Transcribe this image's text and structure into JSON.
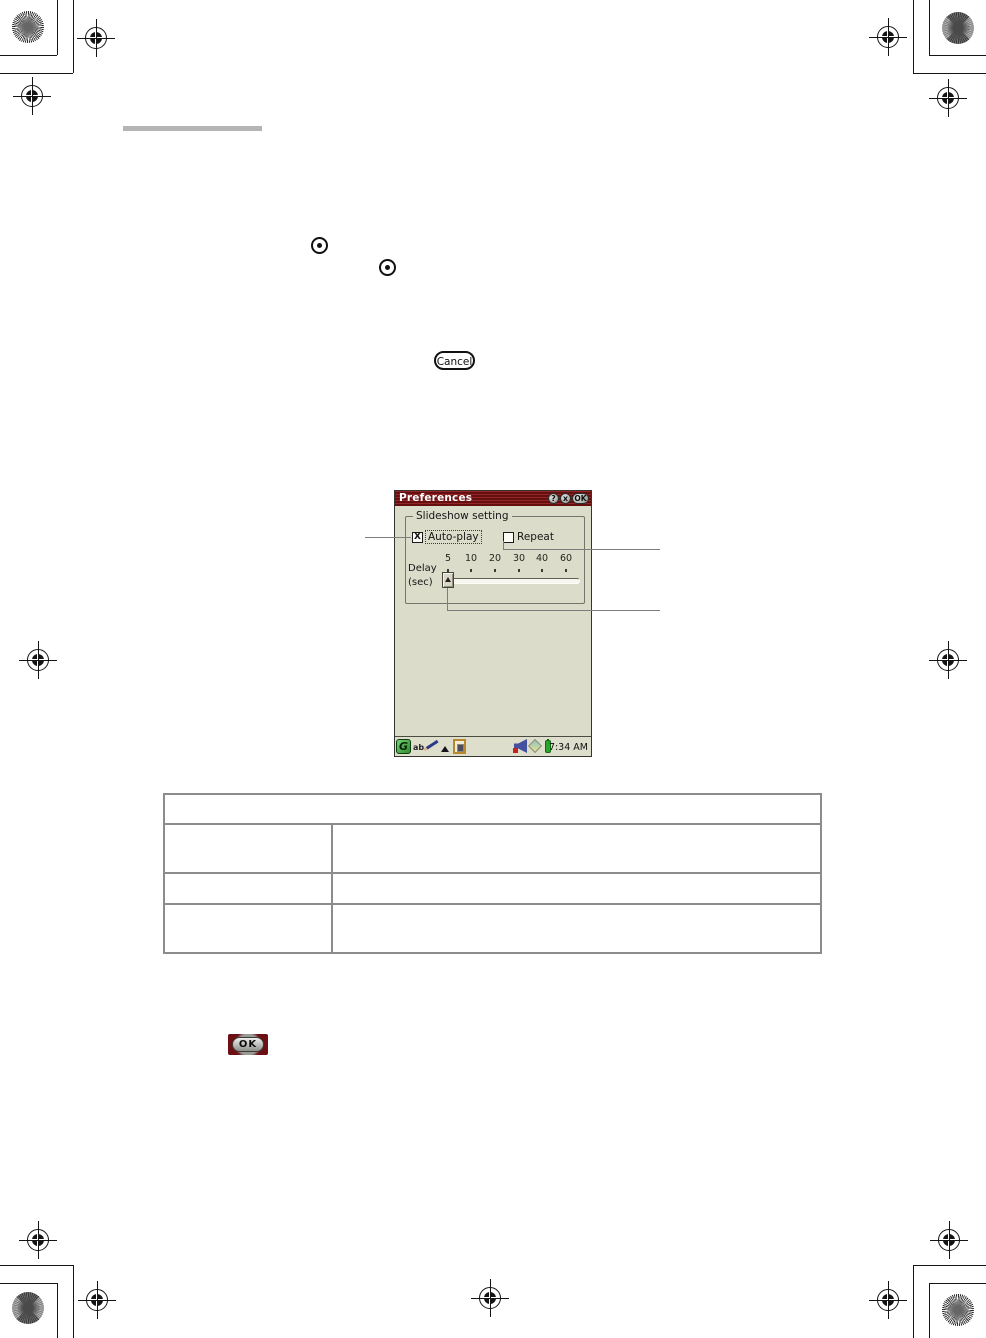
{
  "document": {
    "cancel_button_label": "Cancel",
    "ok_image_label": "OK"
  },
  "dialog": {
    "title": "Preferences",
    "titlebar_buttons": {
      "help": "?",
      "close": "x",
      "ok": "OK"
    },
    "group_label": "Slideshow setting",
    "autoplay_label": "Auto-play",
    "autoplay_checked": true,
    "autoplay_check_glyph": "X",
    "repeat_label": "Repeat",
    "repeat_checked": false,
    "delay_label_line1": "Delay",
    "delay_label_line2": "(sec)",
    "delay_ticks": [
      "5",
      "10",
      "20",
      "30",
      "40",
      "60"
    ],
    "delay_value": "5",
    "statusbar": {
      "graffiti_glyph": "G",
      "ab_glyph": "ab",
      "time": "7:34 AM"
    }
  },
  "table": {
    "header": "",
    "rows": [
      [
        "",
        ""
      ],
      [
        "",
        ""
      ],
      [
        "",
        ""
      ]
    ]
  },
  "colors": {
    "titlebar_red": "#7a1315",
    "dialog_beige": "#dcdccb",
    "graffiti_green": "#3fa03f",
    "battery_green": "#2aa52a",
    "memory_stick_teal": "#8fc6c4"
  }
}
